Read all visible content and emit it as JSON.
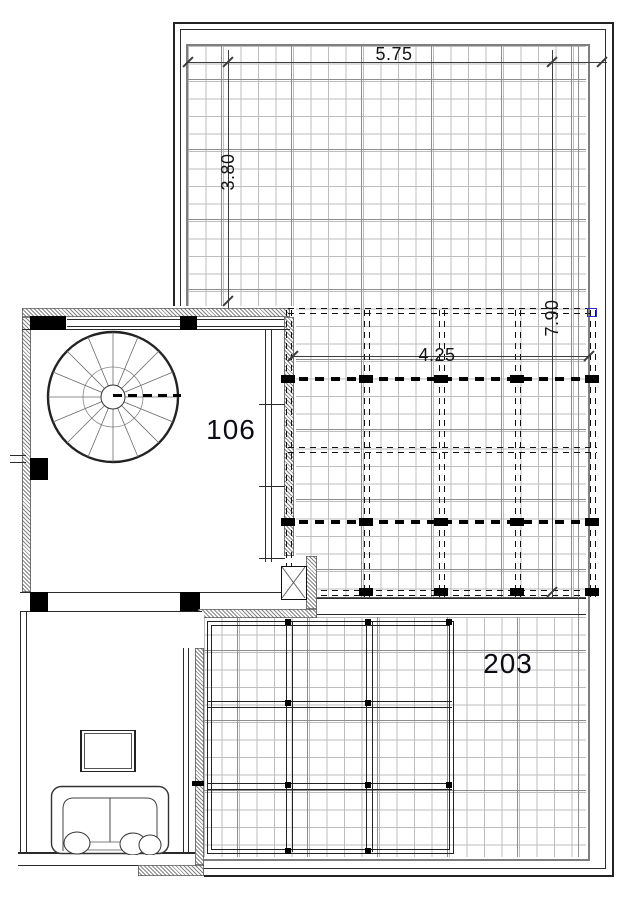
{
  "title": "architectural-floor-plan",
  "labels": {
    "dim_top_width": "5.75",
    "dim_left_height": "3.80",
    "dim_pergola_width": "4.25",
    "dim_right_height": "7.90",
    "room_stair": "106",
    "room_terrace": "203"
  },
  "colors": {
    "line": "#1f1f1f",
    "grid_minor": "#bdbdbd",
    "grid_major": "#8d8d8d",
    "frame_gray": "#7f7f7f",
    "column_fill": "#000000",
    "selection_marker": "#2b2bd0",
    "dim_text": "#141414",
    "background": "#ffffff"
  }
}
